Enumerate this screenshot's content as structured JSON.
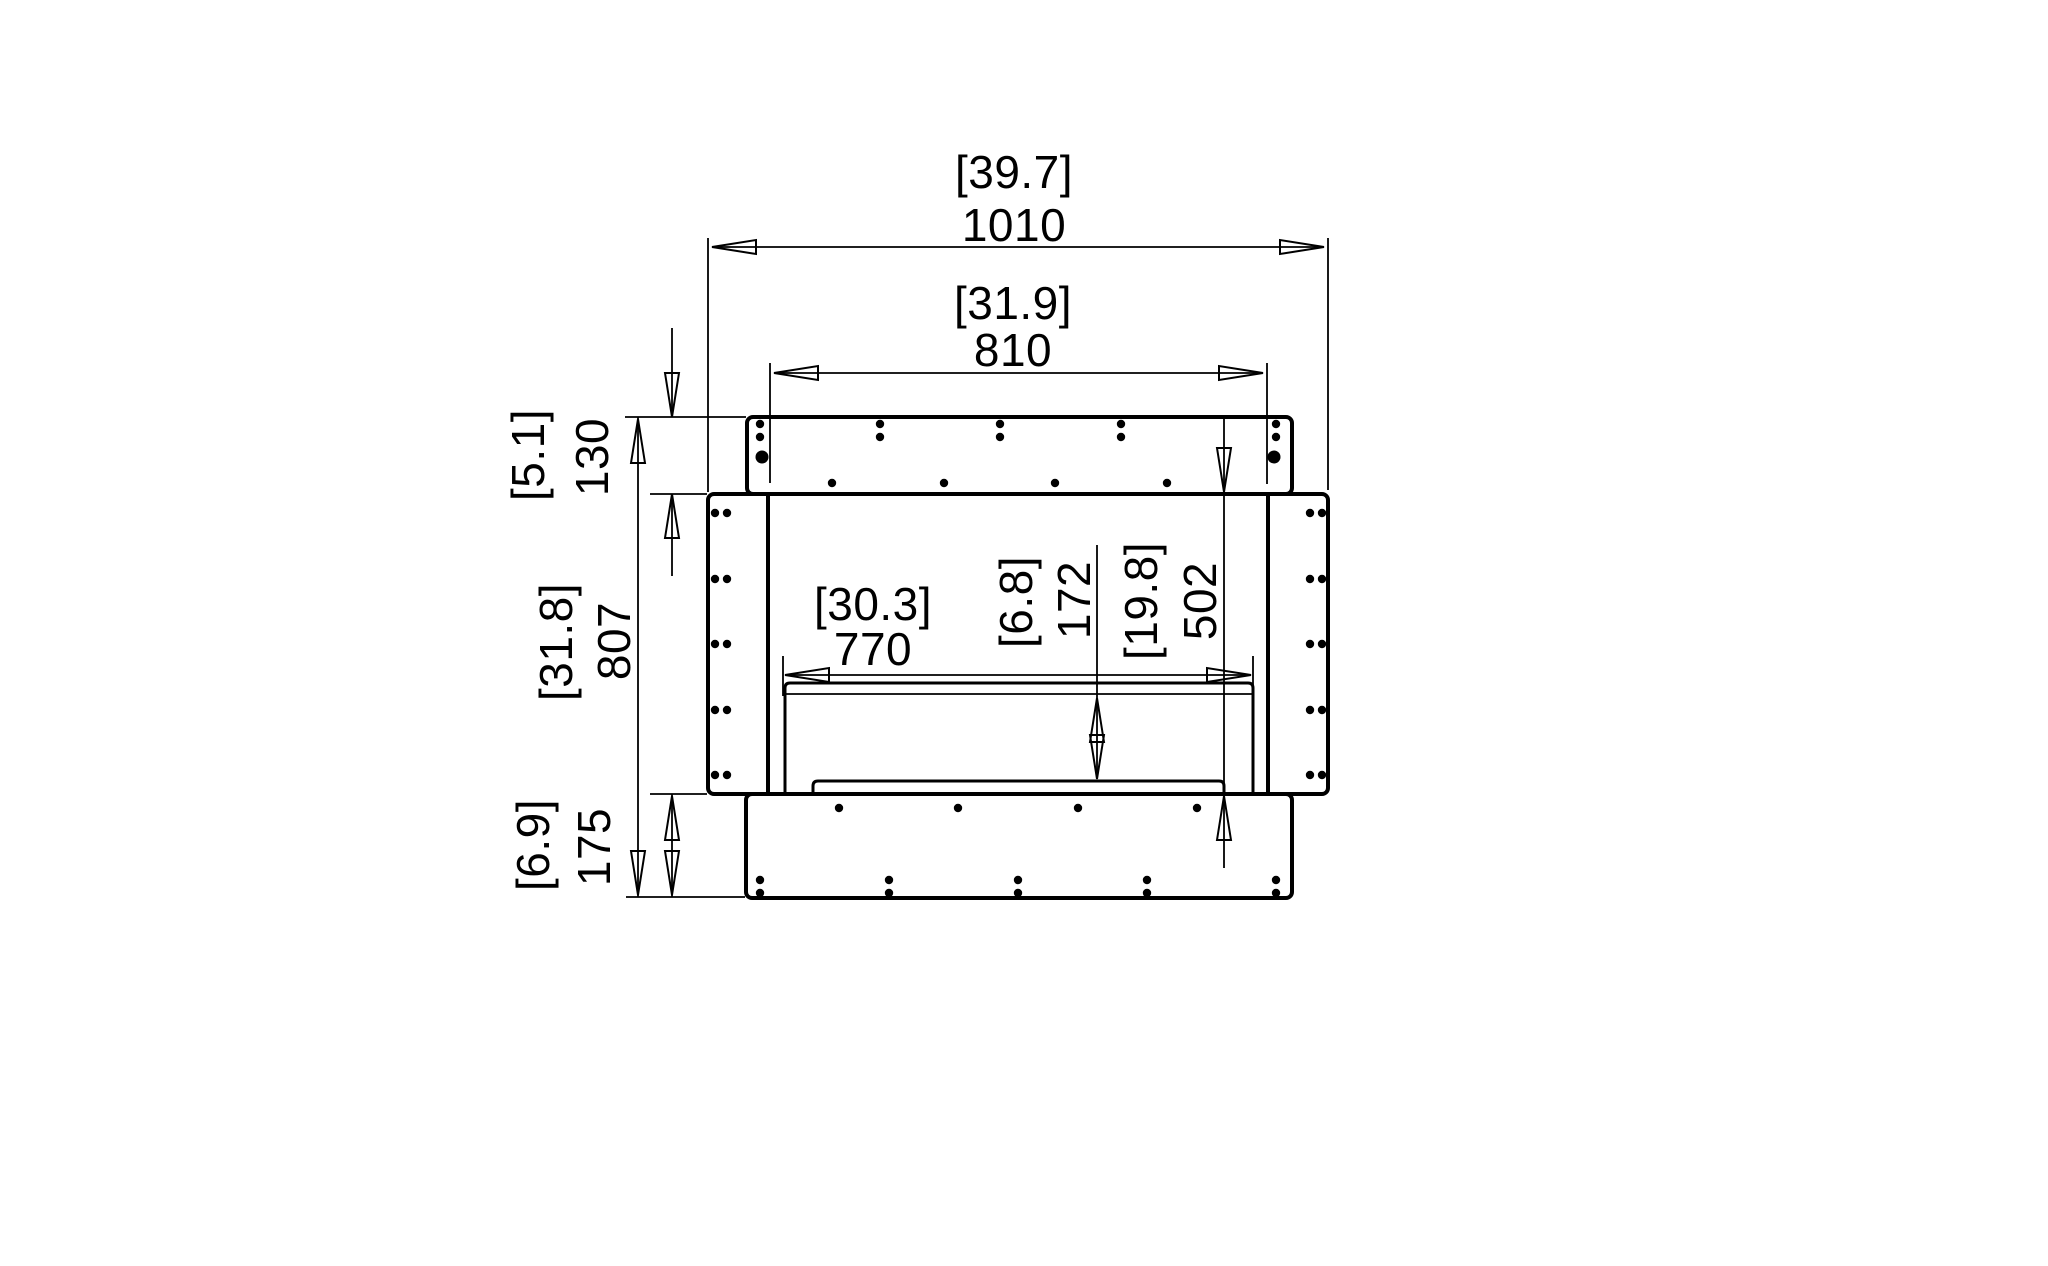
{
  "document": {
    "type": "technical dimension drawing - firebox front view",
    "background_color": "#ffffff",
    "line_color": "#000000",
    "units": "mm [inches]"
  },
  "dimensions": {
    "overall_width": {
      "mm": "1010",
      "inches": "[39.7]"
    },
    "opening_width": {
      "mm": "810",
      "inches": "[31.9]"
    },
    "top_flange_height": {
      "mm": "130",
      "inches": "[5.1]"
    },
    "overall_height": {
      "mm": "807",
      "inches": "[31.8]"
    },
    "base_height": {
      "mm": "175",
      "inches": "[6.9]"
    },
    "burner_width": {
      "mm": "770",
      "inches": "[30.3]"
    },
    "burner_clearance": {
      "mm": "172",
      "inches": "[6.8]"
    },
    "opening_height": {
      "mm": "502",
      "inches": "[19.8]"
    }
  }
}
